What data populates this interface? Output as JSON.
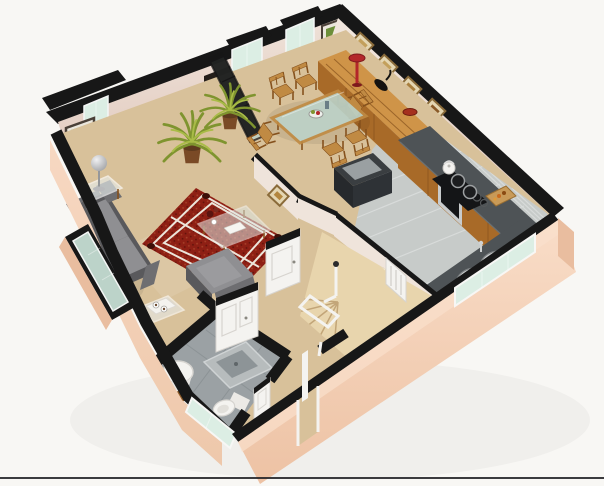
{
  "scene": {
    "title": "3D isometric render of a one-floor apartment floor plan on a white background",
    "type": "architectural 3D floor plan render",
    "background": "white",
    "bottom_border": true,
    "rooms": [
      {
        "id": "living-room",
        "label": "Living room",
        "items": [
          "two-seat gray sofa",
          "gray armchair",
          "red patterned area rug",
          "glass coffee table with white magazine",
          "glass side table with silver sphere lamp",
          "corner glass table with tea tray and two cups",
          "framed green artwork",
          "protruding bay window",
          "side bay window"
        ]
      },
      {
        "id": "dining-area",
        "label": "Dining area",
        "items": [
          "glass-top wooden dining table",
          "six wooden chairs",
          "fruit bowl centerpiece",
          "dark-framed glass partition screen",
          "two potted palm plants",
          "wall niche with gold bowl",
          "two tall bay windows"
        ]
      },
      {
        "id": "sideboard-wall",
        "label": "Sideboard wall",
        "items": [
          "long wooden sideboard",
          "red sculpture lamp",
          "dark figurine",
          "red bowl",
          "four gold-framed pictures",
          "framed green picture",
          "tall white cabinet"
        ]
      },
      {
        "id": "kitchen",
        "label": "Kitchen",
        "items": [
          "dark counter with wooden cabinets",
          "black cooktop with two pots",
          "white kettle",
          "built-in stainless oven",
          "wooden cutting board with food",
          "double stainless sink",
          "window above sink",
          "dark open island chest",
          "gray tiled floor"
        ]
      },
      {
        "id": "hallway",
        "label": "Hallway",
        "items": [
          "white paneled door to living room",
          "white paneled door near kitchen",
          "entry door opening with white jambs",
          "small gold-framed picture"
        ]
      },
      {
        "id": "bathroom",
        "label": "Bathroom",
        "items": [
          "round white pedestal sink",
          "square shower tray",
          "white toilet",
          "wooden mat",
          "white paneled door",
          "exterior window"
        ]
      },
      {
        "id": "staircase",
        "label": "Staircase",
        "items": [
          "beige winder staircase",
          "white railing with dark finial",
          "white wall radiator"
        ]
      }
    ],
    "counts": {
      "dining_chairs": 6,
      "framed_pictures_sideboard_wall": 4,
      "potted_palms": 2,
      "sofa_seat_cushions": 2,
      "cooktop_pots": 2,
      "sink_basins": 2
    }
  },
  "palette": {
    "background": "#f8f7f4",
    "baseline": "#26262a",
    "wall_top": "#171717",
    "interior_wall": "#efe4db",
    "interior_wall_shadow": "#e1c9bd",
    "exterior": "#f3cdb2",
    "exterior_dark": "#e9bd9f",
    "exterior_light": "#fae0cc",
    "carpet": "#d8c19a",
    "carpet_light": "#e8d6b2",
    "kitchen_tile": "#c7cbc9",
    "tile_line": "#d9dddb",
    "bath_tile": "#9ba1a4",
    "bath_tile_dark": "#7e8587",
    "stair": "#e8d5ad",
    "stair_line": "#c2a578",
    "wood": "#c08a43",
    "wood_light": "#cf9448",
    "wood_dark": "#a86a28",
    "wood_deep": "#85511d",
    "counter": "#4e5356",
    "counter_dark": "#33373a",
    "appliance_black": "#141517",
    "steel": "#c8cbcc",
    "steel_dark": "#8d9192",
    "glass": "#bcd3c9",
    "glass_pale": "#dceee4",
    "white_fixture": "#f4f3f0",
    "white_shadow": "#d7d4cf",
    "sofa": "#8f8f92",
    "sofa_mid": "#6e6e71",
    "sofa_dark": "#59595c",
    "rug": "#8e1f14",
    "rug_dark": "#3d0f08",
    "rug_accent": "#a8432a",
    "rug_line": "#ece5da",
    "plant": "#7f942f",
    "plant_light": "#a9bc47",
    "pot": "#7a4a26",
    "accent_red": "#b3272a",
    "gold": "#c98f2e",
    "frame_gold": "#8a6b3a",
    "frame_fill": "#e4d6b2"
  }
}
